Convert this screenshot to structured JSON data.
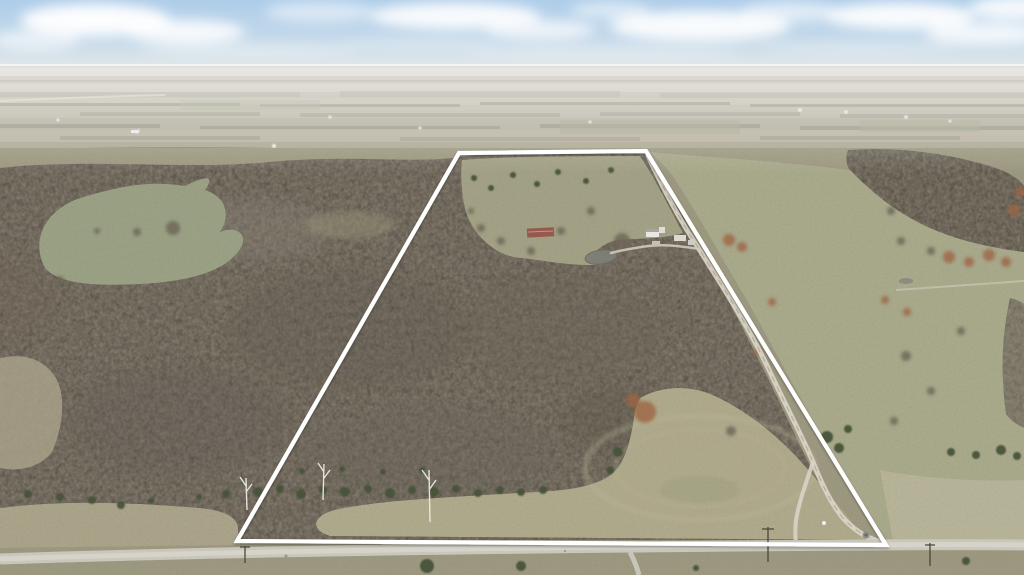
{
  "scene": {
    "kind": "aerial-drone-photo",
    "description": "Winter aerial view of rural wooded acreage outlined with a white property boundary, farmstead at center, gravel lane on the right and county road along the bottom",
    "season": "winter",
    "text_overlays": []
  },
  "palette": {
    "sky_top": "#aecde9",
    "sky_horizon": "#e9eceb",
    "haze": "#e8e7e0",
    "distant_field": "#b8b4a8",
    "woods": "#7d7568",
    "woods_dark": "#5f584d",
    "meadow": "#a2a085",
    "meadow_pale": "#b0aa8d",
    "pasture": "#a8a88b",
    "road_gravel": "#c9c6bc",
    "lane_gravel": "#d8d3c5",
    "cedar_green": "#47523a",
    "rust_shrub": "#9c6743",
    "pond_water": "#7e7f76",
    "boundary_white": "#ffffff"
  },
  "boundary": {
    "points": "459,153 646,151 886,545 237,541",
    "color": "#ffffff",
    "width": "4.2"
  },
  "lane": {
    "path": "M648,156 C662,186 681,222 699,249 C726,292 751,331 770,372 C789,412 804,440 813,462 C819,477 829,501 843,518 C855,531 868,538 878,541",
    "fork_path": "M813,462 C806,483 798,505 796,521 C795,531 795,537 796,542",
    "color": "#d8d3c5"
  },
  "road": {
    "path": "M0,559 C180,553 420,549 640,547 C820,545 940,544 1024,545",
    "branch_path": "M630,552 C634,560 637,567 639,575",
    "color": "#c9c6bc",
    "center_color": "#dad7cd"
  },
  "driveway": {
    "path": "M699,249 C680,246 664,244 648,246 C634,248 622,250 611,253",
    "color": "#cfcabc"
  },
  "farmstead": {
    "barn_roof_color": "#96594e",
    "house_color": "#e9e7e1",
    "shed_color": "#dcd9d1",
    "shed2_color": "#c4c1b9"
  },
  "pond": {
    "cx": 601,
    "cy": 257,
    "rx": 16,
    "ry": 7,
    "color": "#7e7f76"
  },
  "pond_small": {
    "cx": 906,
    "cy": 281,
    "rx": 7,
    "ry": 3
  },
  "scatter": {
    "cedars": {
      "fill": "#47523a",
      "opacity": "0.95",
      "items": [
        [
          258,
          492,
          5
        ],
        [
          280,
          489,
          4
        ],
        [
          301,
          494,
          5
        ],
        [
          323,
          490,
          4
        ],
        [
          345,
          492,
          5
        ],
        [
          368,
          489,
          4
        ],
        [
          390,
          493,
          5
        ],
        [
          412,
          490,
          4
        ],
        [
          434,
          492,
          5
        ],
        [
          456,
          489,
          4
        ],
        [
          478,
          493,
          4
        ],
        [
          500,
          490,
          4
        ],
        [
          521,
          492,
          4
        ],
        [
          543,
          490,
          4
        ],
        [
          302,
          471,
          3
        ],
        [
          342,
          469,
          3
        ],
        [
          383,
          472,
          3
        ],
        [
          422,
          470,
          3
        ],
        [
          28,
          494,
          4
        ],
        [
          60,
          497,
          4
        ],
        [
          92,
          500,
          4
        ],
        [
          121,
          505,
          4
        ],
        [
          151,
          501,
          3
        ],
        [
          199,
          497,
          3
        ],
        [
          226,
          494,
          4
        ],
        [
          474,
          178,
          3
        ],
        [
          491,
          188,
          3
        ],
        [
          513,
          175,
          3
        ],
        [
          537,
          184,
          3
        ],
        [
          558,
          172,
          3
        ],
        [
          586,
          181,
          3
        ],
        [
          611,
          170,
          3
        ],
        [
          618,
          452,
          5
        ],
        [
          610,
          470,
          4
        ],
        [
          827,
          437,
          6
        ],
        [
          839,
          448,
          5
        ],
        [
          848,
          429,
          4
        ],
        [
          951,
          452,
          4
        ],
        [
          976,
          455,
          4
        ],
        [
          1001,
          450,
          5
        ],
        [
          1017,
          456,
          4
        ],
        [
          427,
          566,
          7
        ],
        [
          521,
          566,
          5
        ],
        [
          966,
          561,
          4
        ],
        [
          696,
          568,
          3
        ]
      ]
    },
    "rust_shrubs": {
      "fill": "#9c6743",
      "opacity": "0.8",
      "items": [
        [
          645,
          412,
          11
        ],
        [
          633,
          400,
          7
        ],
        [
          729,
          240,
          6
        ],
        [
          742,
          247,
          5
        ],
        [
          949,
          257,
          6
        ],
        [
          969,
          262,
          5
        ],
        [
          989,
          255,
          6
        ],
        [
          1006,
          262,
          5
        ],
        [
          1014,
          210,
          6
        ],
        [
          1020,
          192,
          5
        ],
        [
          758,
          352,
          4
        ],
        [
          772,
          302,
          4
        ],
        [
          885,
          300,
          4
        ],
        [
          907,
          312,
          4
        ]
      ]
    },
    "bare_trees": {
      "fill": "#6e6758",
      "opacity": "0.85",
      "items": [
        [
          173,
          228,
          7
        ],
        [
          137,
          232,
          4
        ],
        [
          97,
          231,
          3
        ],
        [
          622,
          241,
          8
        ],
        [
          591,
          211,
          4
        ],
        [
          561,
          231,
          4
        ],
        [
          681,
          320,
          6
        ],
        [
          651,
          341,
          5
        ],
        [
          706,
          371,
          5
        ],
        [
          661,
          291,
          4
        ],
        [
          731,
          431,
          5
        ],
        [
          762,
          411,
          4
        ],
        [
          906,
          356,
          5
        ],
        [
          931,
          391,
          4
        ],
        [
          961,
          331,
          4
        ],
        [
          894,
          421,
          4
        ],
        [
          481,
          228,
          4
        ],
        [
          501,
          241,
          4
        ],
        [
          531,
          251,
          4
        ],
        [
          471,
          211,
          3
        ],
        [
          916,
          181,
          5
        ],
        [
          941,
          201,
          4
        ],
        [
          891,
          211,
          4
        ],
        [
          961,
          231,
          5
        ],
        [
          901,
          241,
          4
        ],
        [
          931,
          251,
          4
        ],
        [
          196,
          310,
          5
        ],
        [
          226,
          330,
          4
        ],
        [
          120,
          300,
          4
        ],
        [
          80,
          330,
          5
        ],
        [
          150,
          350,
          4
        ],
        [
          60,
          280,
          4
        ]
      ]
    },
    "distant_buildings": {
      "fill": "#f2f1ec",
      "opacity": "0.95",
      "items": [
        [
          137,
          131,
          2.5
        ],
        [
          274,
          146,
          2
        ],
        [
          800,
          110,
          1.8
        ],
        [
          846,
          112,
          1.8
        ],
        [
          906,
          117,
          1.8
        ],
        [
          950,
          121,
          1.5
        ],
        [
          420,
          128,
          1.5
        ],
        [
          590,
          122,
          1.5
        ],
        [
          58,
          120,
          1.5
        ],
        [
          330,
          117,
          1.5
        ]
      ]
    }
  }
}
